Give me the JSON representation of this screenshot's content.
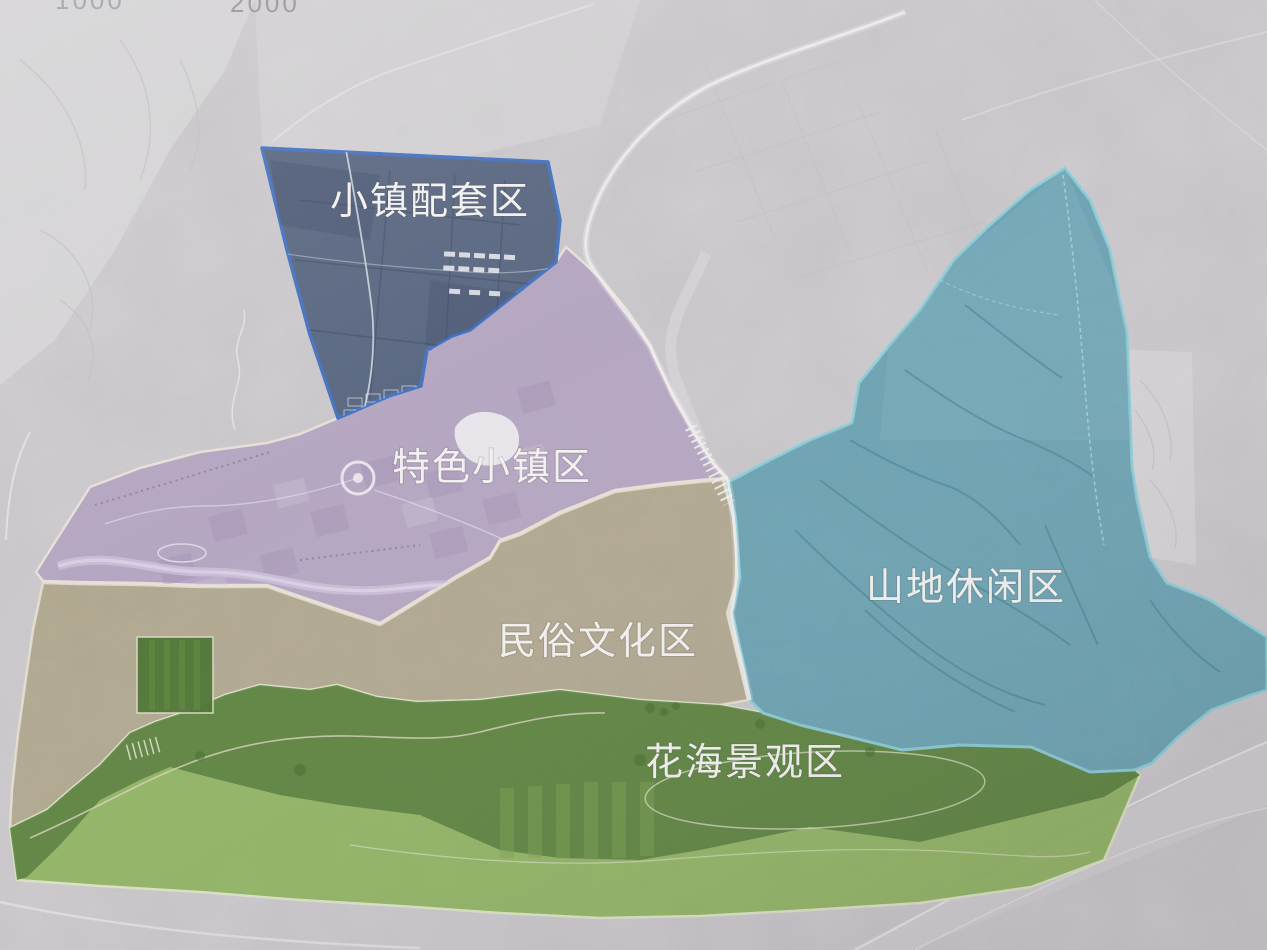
{
  "map": {
    "kind": "tourism-planning-zoning-map",
    "scale_marks": {
      "mark1": "1000",
      "mark2": "2000"
    },
    "zones": [
      {
        "name": "town-supporting-area",
        "label": "小镇配套区",
        "fill": "#51607c",
        "border": "#3a6cc0"
      },
      {
        "name": "featured-town-area",
        "label": "特色小镇区",
        "fill": "#b3a3c1",
        "border": "#ece5da"
      },
      {
        "name": "folk-culture-area",
        "label": "民俗文化区",
        "fill": "#b2a98f",
        "border": "#e9e2d2"
      },
      {
        "name": "mountain-leisure-area",
        "label": "山地休闲区",
        "fill": "#66a3b3",
        "border": "#8ad2de"
      },
      {
        "name": "flower-sea-landscape-area",
        "label": "花海景观区",
        "fill": "#90b560",
        "border": "#dce6c4"
      }
    ]
  }
}
